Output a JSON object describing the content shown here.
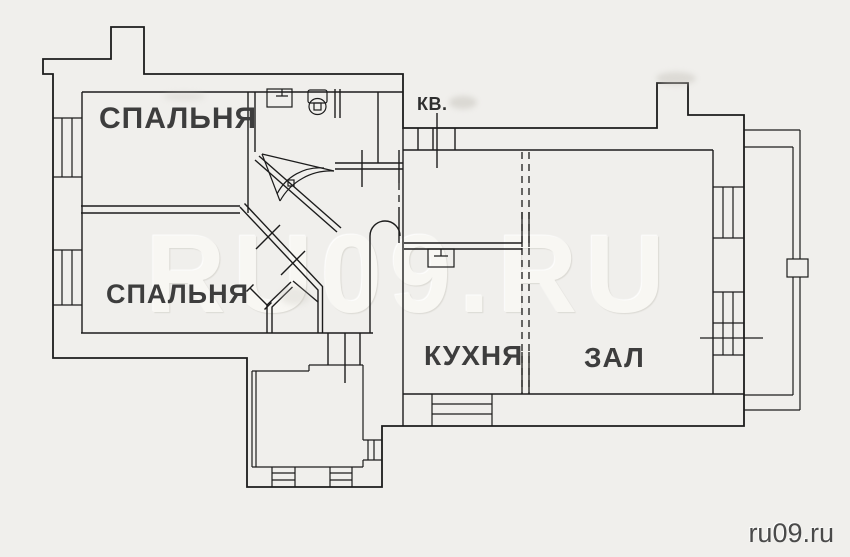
{
  "plan": {
    "type": "apartment floor plan scan",
    "apartment_label": "КВ.",
    "watermark": "RU09.RU",
    "site_credit": "ru09.ru",
    "rooms": [
      {
        "id": "bedroom-1",
        "label": "СПАЛЬНЯ"
      },
      {
        "id": "bedroom-2",
        "label": "СПАЛЬНЯ"
      },
      {
        "id": "kitchen",
        "label": "КУХНЯ"
      },
      {
        "id": "living-room",
        "label": "ЗАЛ"
      }
    ],
    "fixtures": [
      "bathroom-sink",
      "toilet",
      "corner-shower-door-arc",
      "kitchen-sink"
    ],
    "colors": {
      "background": "#f0efec",
      "wall_line": "#1c1c1c",
      "room_label_text": "#3d3d3d",
      "watermark_text": "#f8f7f3",
      "credit_text": "#4a4a4a"
    }
  }
}
